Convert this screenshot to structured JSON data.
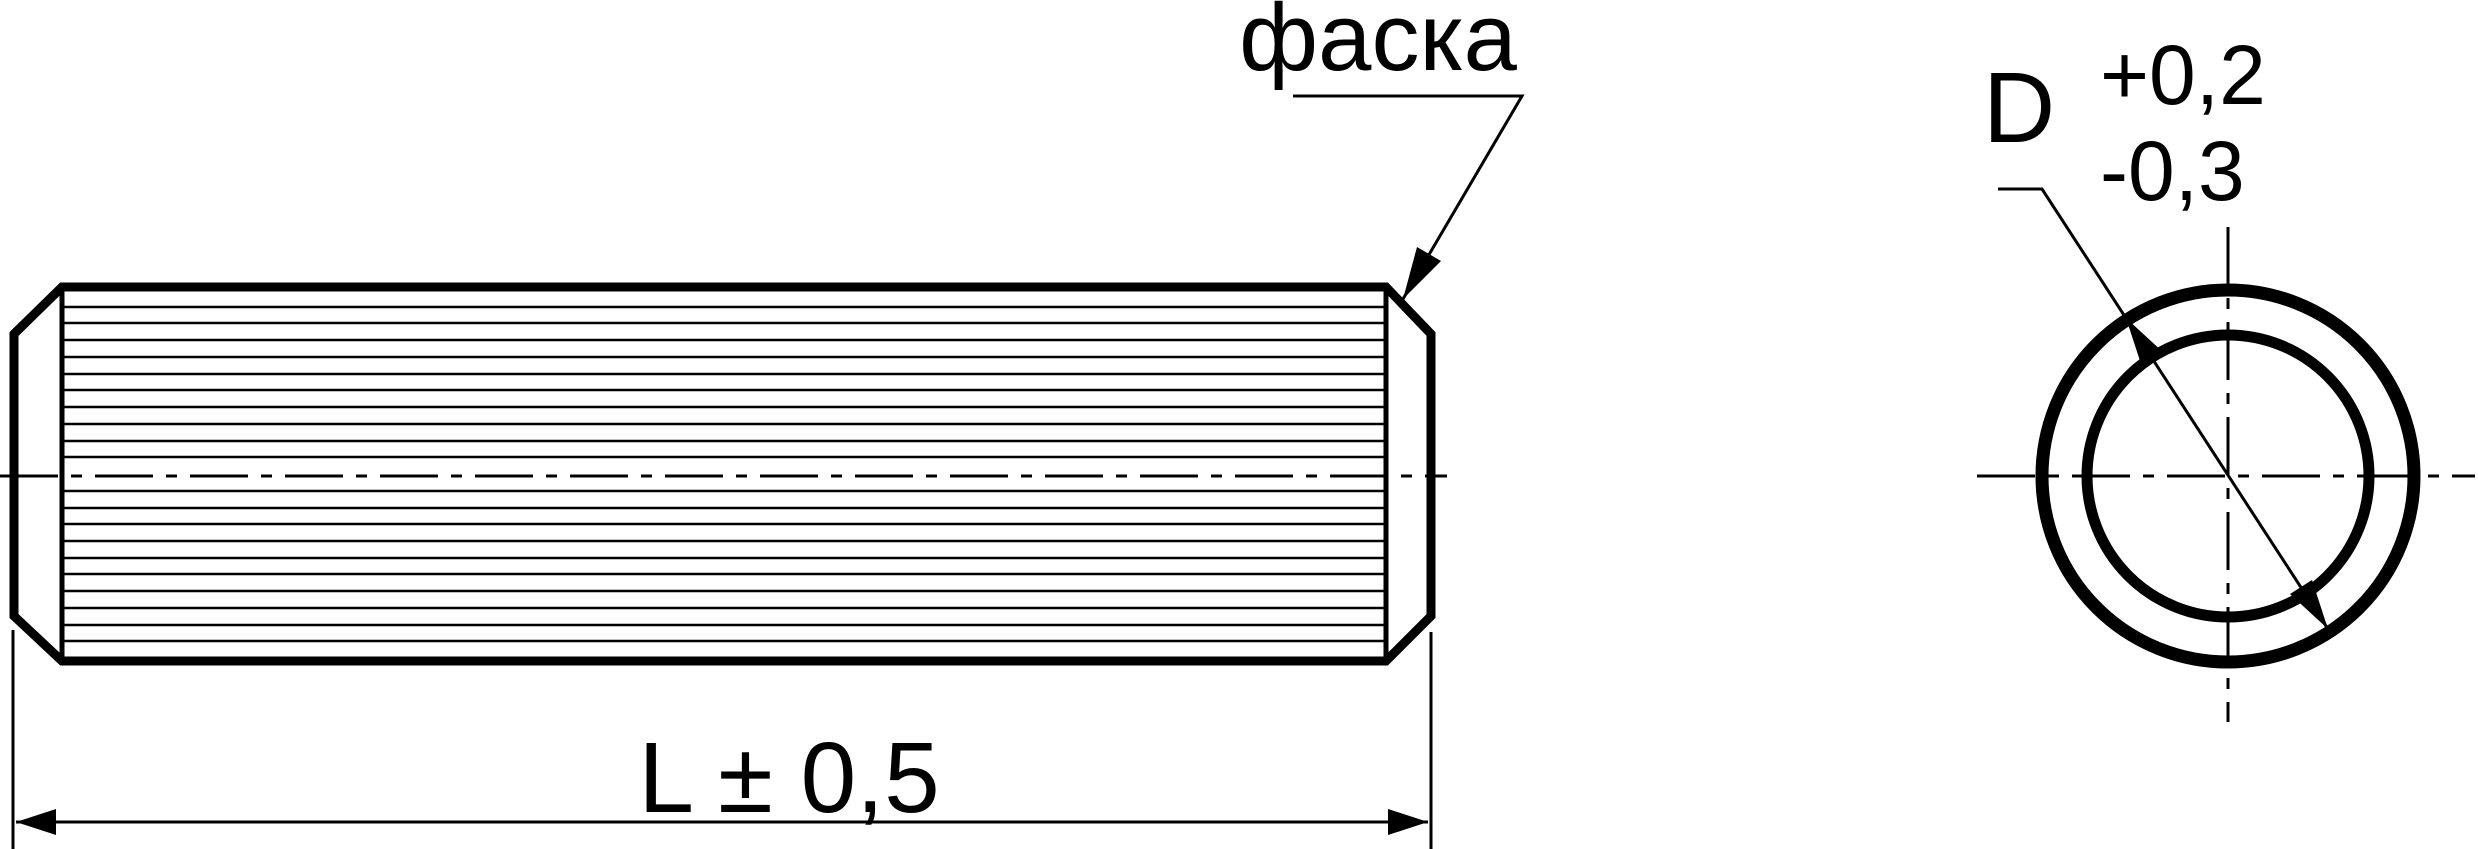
{
  "page": {
    "background_color": "#ffffff",
    "line_color": "#000000"
  },
  "drawing": {
    "chamfer_callout": {
      "label": "фаска"
    },
    "length_dimension": {
      "label": "L ± 0,5"
    },
    "diameter_dimension": {
      "letter": "D",
      "upper_tolerance": "+0,2",
      "lower_tolerance": "-0,3"
    }
  }
}
